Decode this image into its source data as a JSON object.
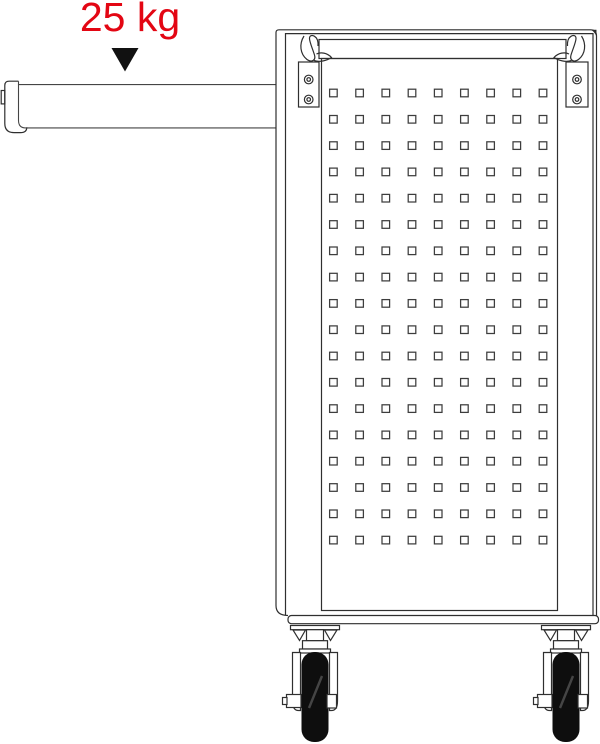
{
  "colors": {
    "accent_red": "#e30613",
    "line": "#2f2f2f",
    "line_light": "#454545",
    "wheel_black": "#0e0e0e",
    "arrow_black": "#111111"
  },
  "annotation": {
    "load_label": "25 kg",
    "arrow_icon": "down-triangle"
  },
  "drawing": {
    "subject": "workshop-trolley-side-view-with-cantilever-arm",
    "pegboard": {
      "columns": 9,
      "rows": 18,
      "hole_shape": "square"
    },
    "corner_brackets": {
      "count": 2,
      "screws_per_bracket": 2
    },
    "casters": {
      "count": 2,
      "wheel_color": "#0e0e0e"
    }
  }
}
